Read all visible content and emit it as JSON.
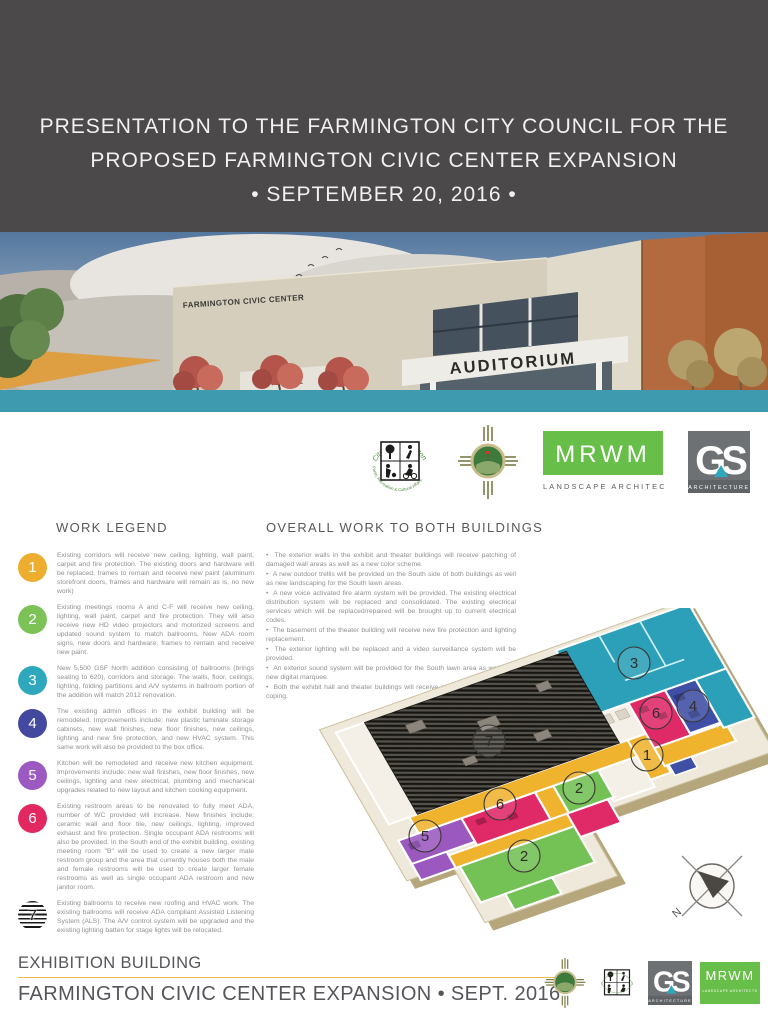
{
  "header": {
    "line1": "PRESENTATION TO THE FARMINGTON CITY COUNCIL FOR THE",
    "line2": "PROPOSED FARMINGTON CIVIC CENTER EXPANSION",
    "line3": "•  SEPTEMBER 20, 2016  •"
  },
  "rendering": {
    "main_sign": "FARMINGTON CIVIC CENTER",
    "auditorium_sign": "AUDITORIUM",
    "left_sign": "CIVIC HALL"
  },
  "logos": {
    "parks_top": "City of Farmington",
    "parks_bottom": "Parks, Recreation & Cultural Affairs",
    "mrwm": "MRWM",
    "mrwm_caption": "LANDSCAPE ARCHITECTS",
    "gs": "GS",
    "gs_caption": "ARCHITECTURE"
  },
  "work_legend": {
    "title": "WORK LEGEND",
    "items": [
      {
        "number": "1",
        "color": "#EDAD2E",
        "striped": false,
        "text": "Existing corridors will receive new ceiling, lighting, wall paint, carpet and fire protection. The existing doors and hardware will be replaced, frames to remain and receive new paint (aluminum storefront doors, frames and hardware will remain as is, no new work)"
      },
      {
        "number": "2",
        "color": "#7DC257",
        "striped": false,
        "text": "Existing meetings rooms A and C-F will receive new ceiling, lighting, wall paint, carpet and fire protection. They will also receive new HD video projectors and motorized screens and updated sound system to match ballrooms, New ADA room signs, new doors and hardware, frames to remain and receive new paint."
      },
      {
        "number": "3",
        "color": "#2FA8BE",
        "striped": false,
        "text": "New 5,500 GSF North addition consisting of ballrooms (brings seating to 620), corridors and storage.  The walls, floor, ceilings, lighting, folding partitions and A/V systems in ballroom portion of the addition will match 2012 renovation."
      },
      {
        "number": "4",
        "color": "#42499E",
        "striped": false,
        "text": "The existing admin offices in the exhibit building will be remodeled. Improvements include: new plastic laminate storage cabinets, new wall finishes, new floor finishes, new ceilings, lighting and new fire protection, and new HVAC system.  This same work will also be provided to the box office."
      },
      {
        "number": "5",
        "color": "#9D59C2",
        "striped": false,
        "text": "Kitchen will be remodeled and receive new kitchen equipment. Improvements include: new wall finishes, new floor finishes, new ceilings, lighting and new electrical, plumbing and mechanical upgrades related to new layout and kitchen cooking equipment."
      },
      {
        "number": "6",
        "color": "#E22860",
        "striped": false,
        "text": "Existing restroom areas to be renovated to fully meet ADA, number of WC provided will increase.  New finishes include: ceramic wall and floor tile, new ceilings, lighting, improved exhaust and fire protection.  Single occupant ADA restrooms will also be provided. In the South end of the exhibit building, existing meeting room \"B\" will be used to create a new larger male restroom group and the area that currently houses both the male and female restrooms will be used to create larger female restrooms as well as single occupant ADA restroom and new janitor room."
      },
      {
        "number": "7",
        "color": "#1b1b1b",
        "striped": true,
        "text": "Existing ballrooms to receive new roofing and HVAC work.  The existing ballrooms will receive ADA compliant Assisted Listening System (ALS).  The A/V control system will be upgraded and the existing lighting batten for stage lights will be relocated."
      }
    ]
  },
  "overall_work": {
    "title": "OVERALL WORK TO BOTH BUILDINGS",
    "bullets": [
      "The exterior walls in the exhibit and theater buildings will receive patching of damaged wall areas as well as a new color scheme.",
      "A new outdoor trellis will be provided on the South side of both buildings as well as new landscaping for the South lawn areas.",
      "A new voice activated fire alarm system will be provided.  The existing electrical distribution system will be replaced and consolidated.  The existing electrical services which will be replaced/repaired will be brought up to current electrical codes.",
      "The basement of the theater building will receive new fire protection and lighting replacement.",
      "The exterior lighting will be replaced and a video surveillance system will be provided.",
      "An exterior sound system will be provided for the South lawn area as well as a new digital marquee.",
      "Both the exhibit hall and theater buildings will receive new roofing and parapet coping."
    ]
  },
  "floor_plan": {
    "markers": [
      {
        "label": "3",
        "x": 330,
        "y": 55
      },
      {
        "label": "7",
        "x": 185,
        "y": 133
      },
      {
        "label": "6",
        "x": 352,
        "y": 105
      },
      {
        "label": "4",
        "x": 389,
        "y": 98
      },
      {
        "label": "1",
        "x": 343,
        "y": 147
      },
      {
        "label": "6",
        "x": 196,
        "y": 196
      },
      {
        "label": "2",
        "x": 275,
        "y": 180
      },
      {
        "label": "5",
        "x": 121,
        "y": 228
      },
      {
        "label": "2",
        "x": 220,
        "y": 248
      }
    ],
    "compass_label": "N",
    "colors": {
      "corridor": "#F0B32E",
      "meeting": "#74C255",
      "addition": "#2BA0B8",
      "admin": "#3F4FA5",
      "kitchen": "#9B59C0",
      "restroom": "#E02A68"
    }
  },
  "footer": {
    "building": "EXHIBITION BUILDING",
    "project": "FARMINGTON CIVIC CENTER EXPANSION  •  SEPT. 2016"
  }
}
